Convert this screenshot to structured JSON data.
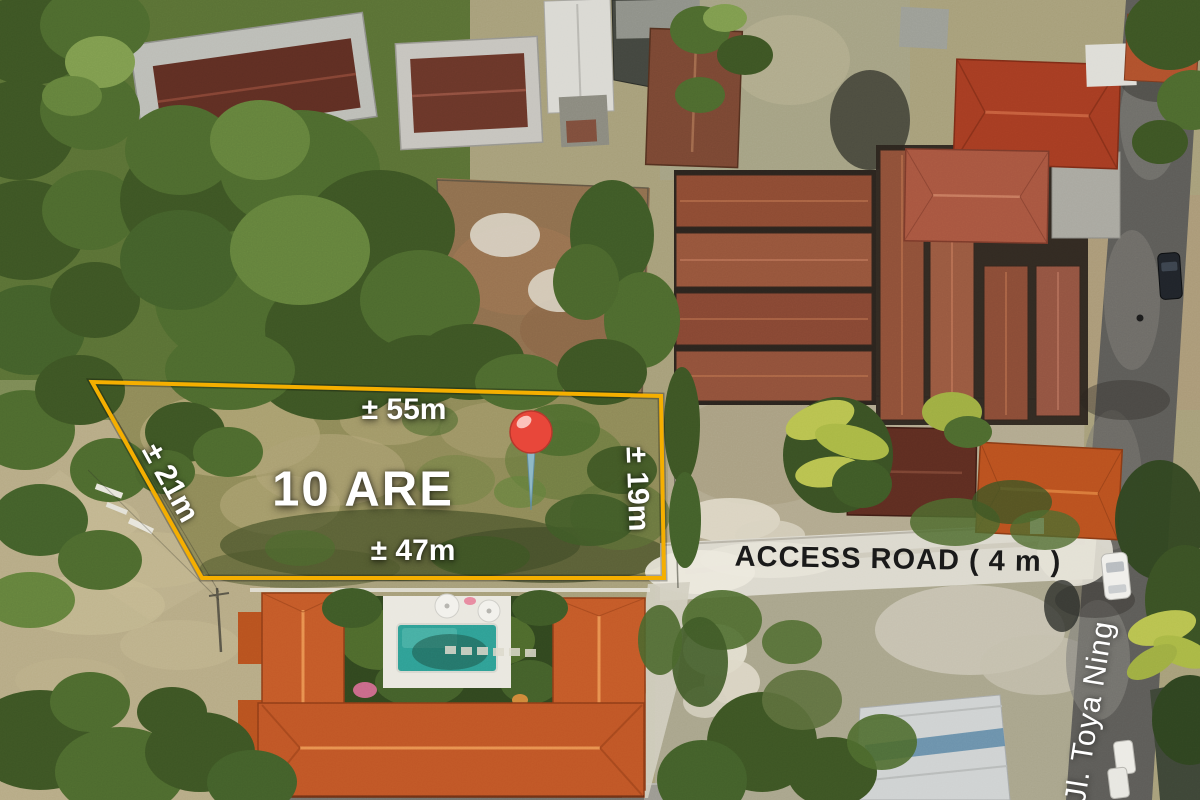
{
  "plot": {
    "area_label": "10 ARE",
    "dimensions": {
      "top": "± 55m",
      "bottom": "± 47m",
      "left": "± 21m",
      "right": "± 19m"
    },
    "boundary_color": "#F5AF00"
  },
  "labels": {
    "access_road": "ACCESS ROAD ( 4 m )",
    "street_name": "Jl. Toya Ning"
  },
  "pin": {
    "icon": "map-pin",
    "color": "#E8473A"
  }
}
